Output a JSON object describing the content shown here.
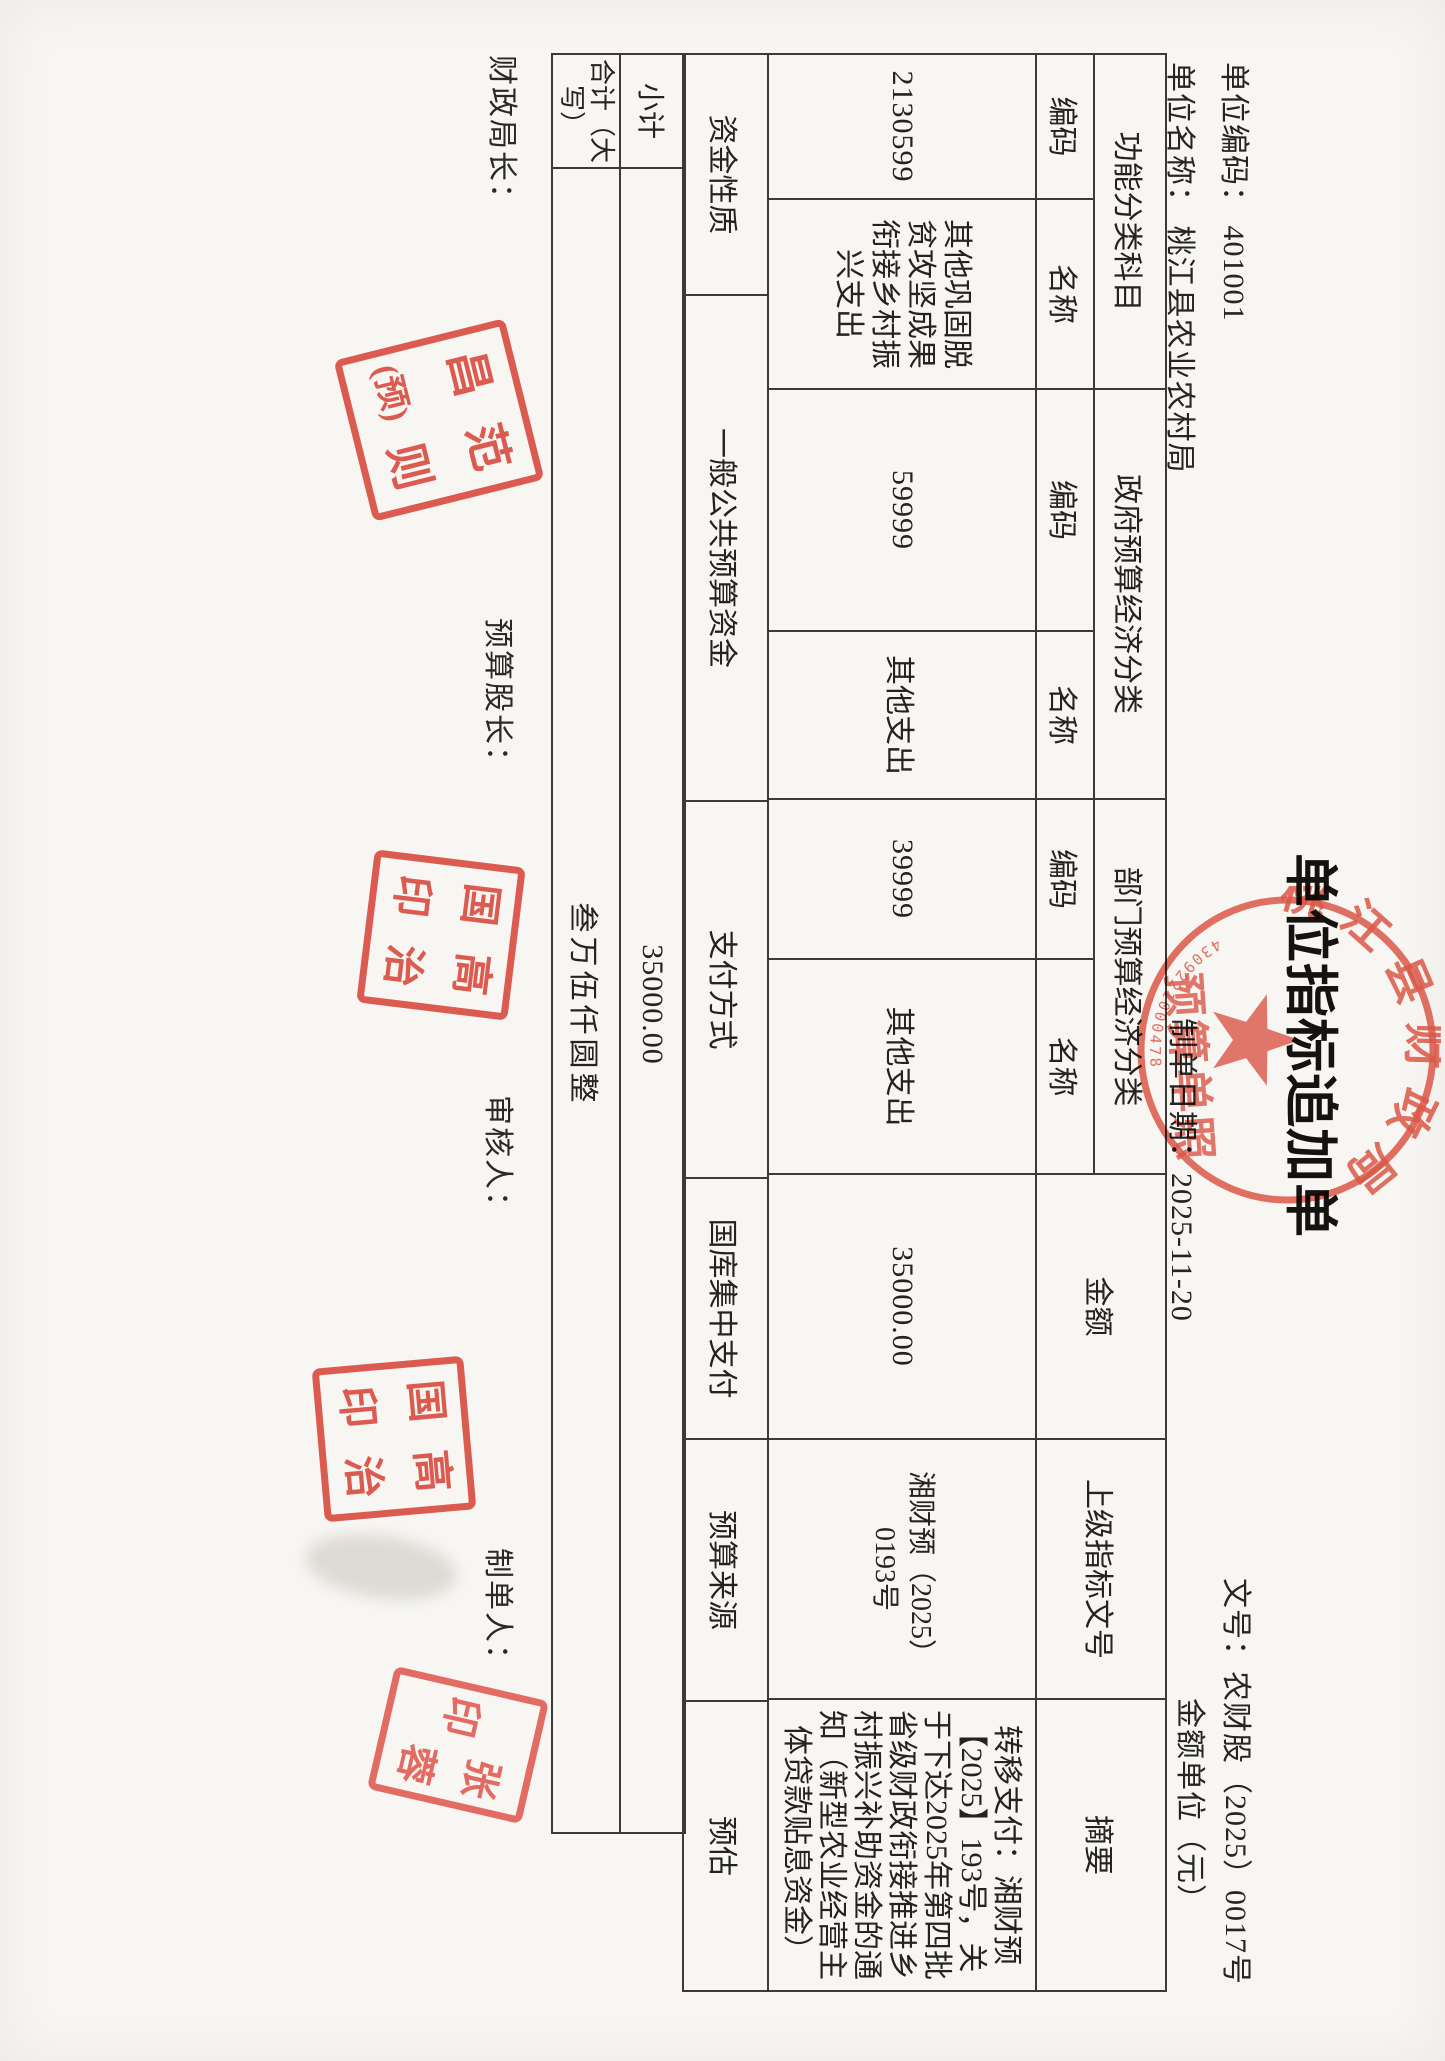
{
  "header": {
    "title": "单位指标追加单",
    "unit_code_line": "单位编码： 401001",
    "unit_name_line": "单位名称： 桃江县农业农村局",
    "date_line": "制单日期：2025-11-20",
    "doc_no_line": "文号：农财股（2025）0017号",
    "amount_unit_line": "金额单位（元）"
  },
  "table": {
    "group_headers": [
      "功能分类科目",
      "政府预算经济分类",
      "部门预算经济分类"
    ],
    "col_headers": {
      "code": "编码",
      "name": "名称",
      "amount": "金额",
      "doc": "上级指标文号",
      "summary": "摘要"
    },
    "row": {
      "func_code": "2130599",
      "func_name": "其他巩固脱贫攻坚成果衔接乡村振兴支出",
      "gov_code": "59999",
      "gov_name": "其他支出",
      "dept_code": "39999",
      "dept_name": "其他支出",
      "amount": "35000.00",
      "doc_no": "湘财预（2025）0193号",
      "summary": "转移支付：湘财预【2025】193号，关于下达2025年第四批省级财政衔接推进乡村振兴补助资金的通知（新型农业经营主体贷款贴息资金）"
    },
    "attr_row": {
      "fund_label": "资金性质",
      "fund_value": "一般公共预算资金",
      "pay_label": "支付方式",
      "pay_value": "国库集中支付",
      "source_label": "预算来源",
      "source_value": "预估"
    },
    "subtotal": {
      "label": "小计",
      "value": "35000.00"
    },
    "total": {
      "label": "合计（大写）",
      "value": "叁万伍仟圆整"
    }
  },
  "signatures": {
    "finance_director": "财政局长：",
    "budget_chief": "预算股长：",
    "auditor": "审核人：",
    "preparer": "制单人："
  },
  "stamps": {
    "round": {
      "ring_text": "桃江县财政局",
      "inner_text": "预算单照",
      "serial": "4309221000478",
      "color": "#d6402f"
    },
    "fan": {
      "tl": "昌",
      "tr": "范",
      "bl": "(预)",
      "br": "则"
    },
    "gao": {
      "tl": "国",
      "tr": "高",
      "bl": "印",
      "br": "治"
    },
    "zhang": {
      "left": "印",
      "right_top": "张",
      "right_bottom": "蓉"
    }
  }
}
